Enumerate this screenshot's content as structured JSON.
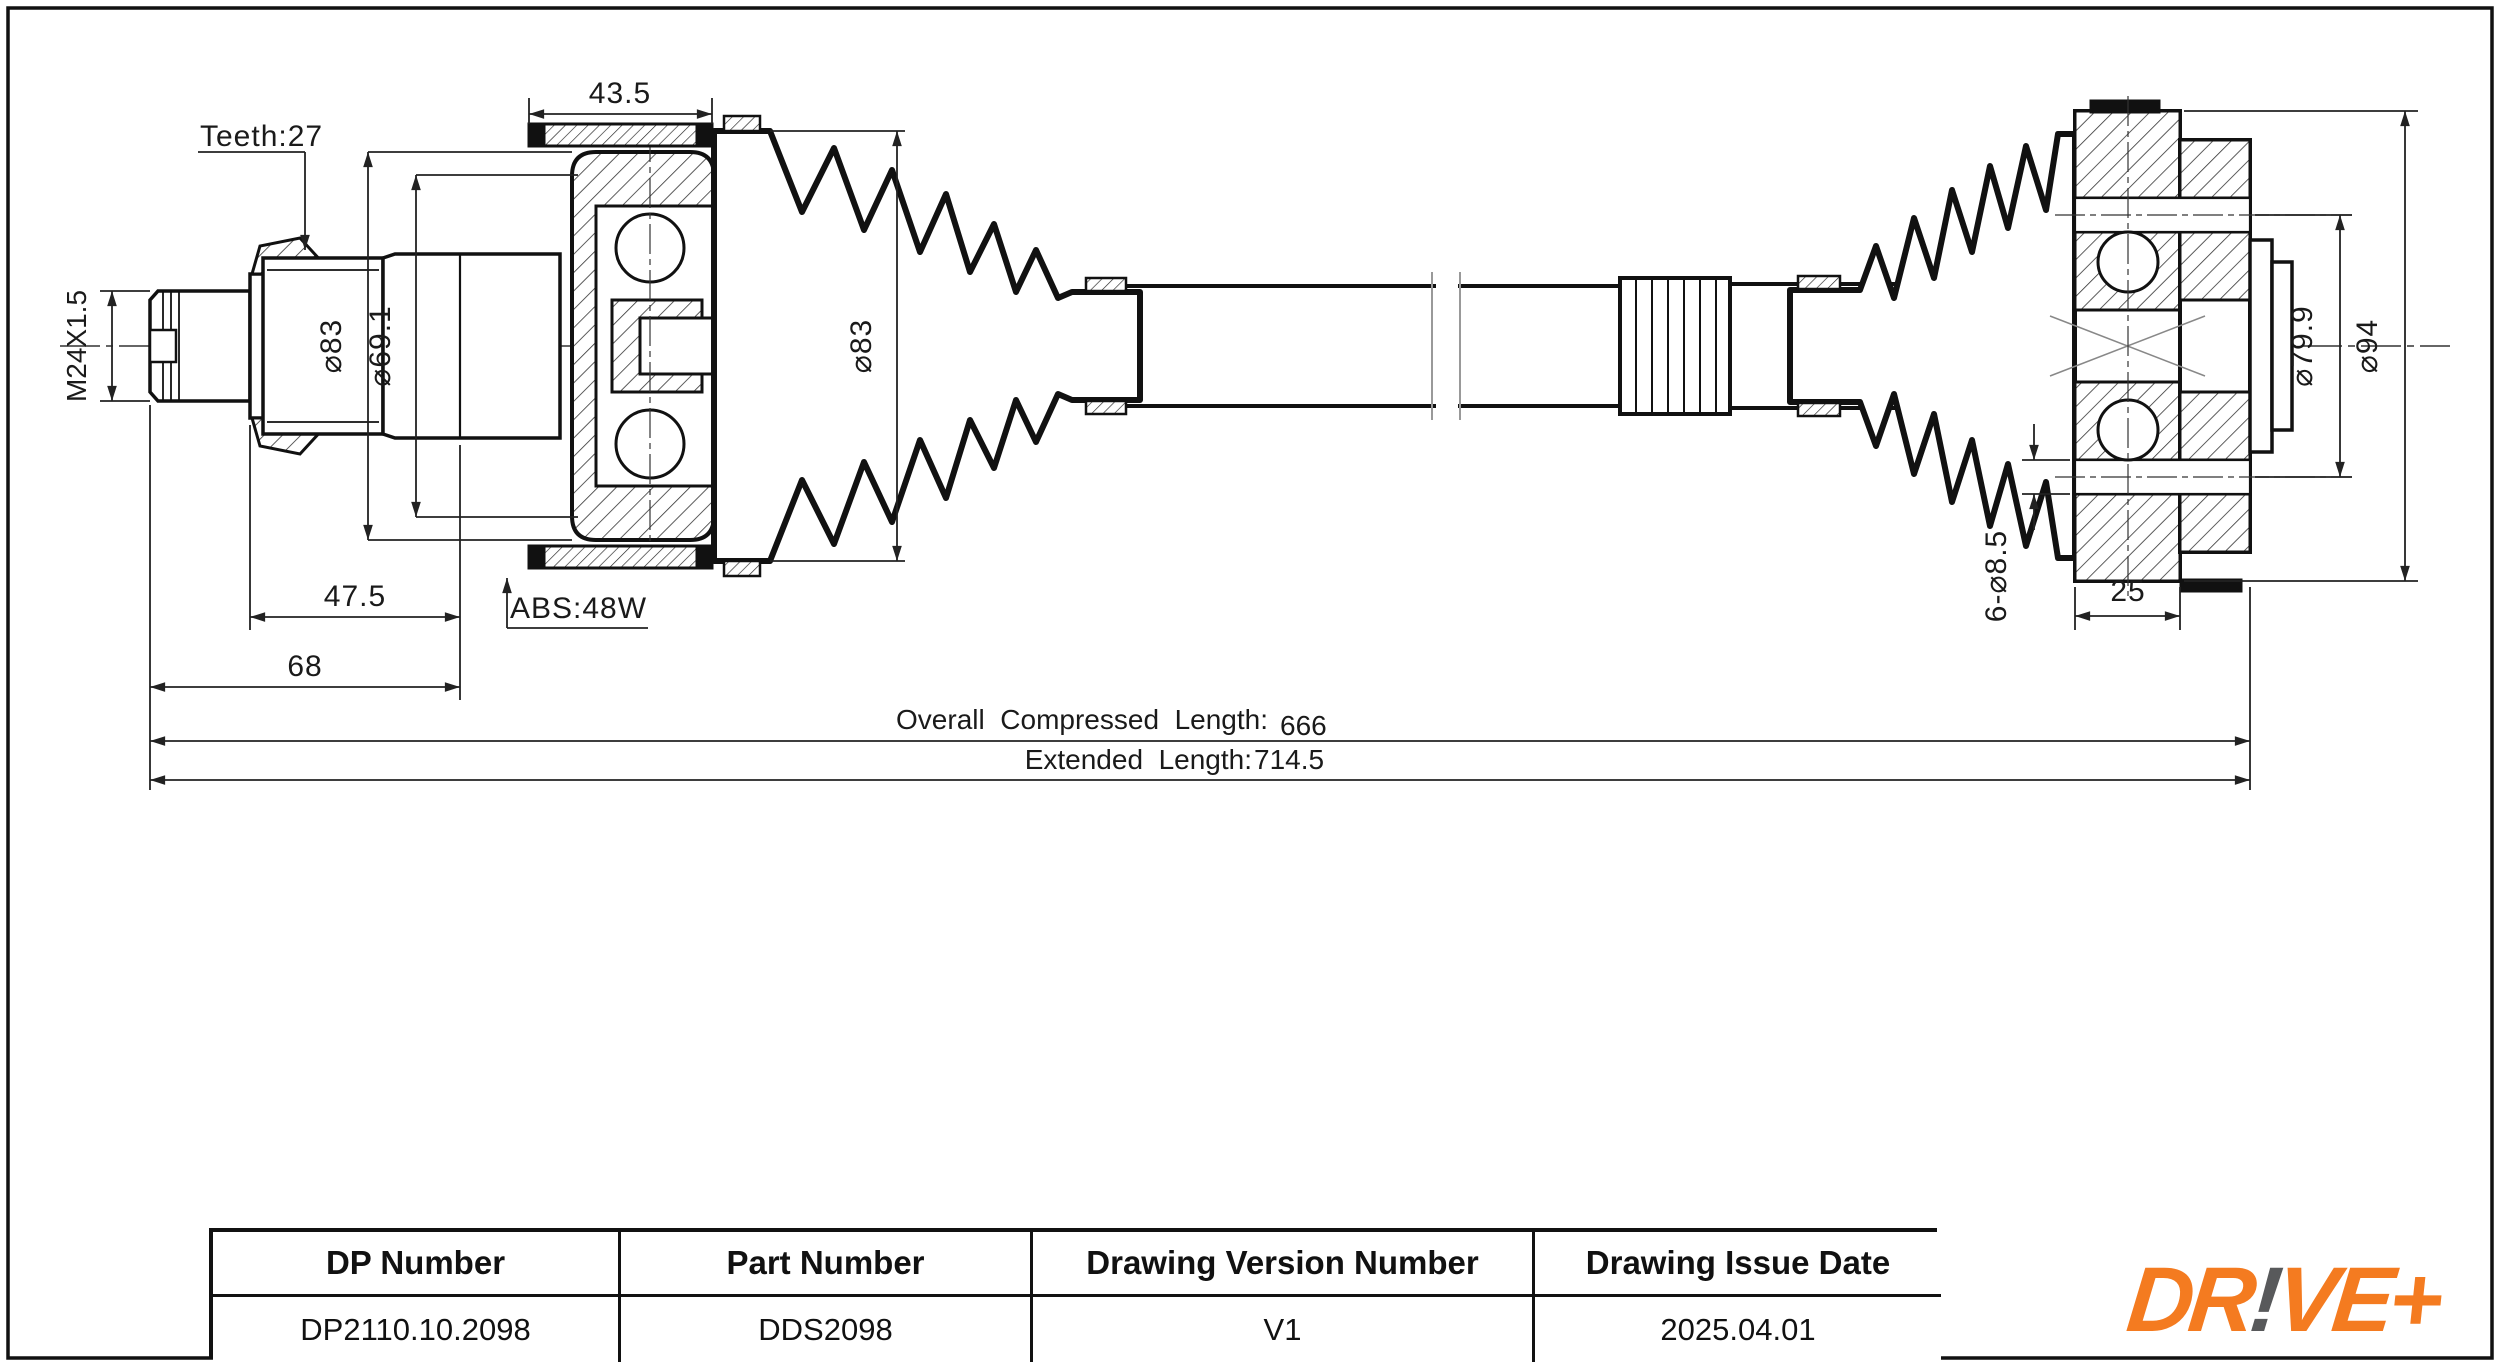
{
  "annotations": {
    "teeth_label": "Teeth:27",
    "abs_label": "ABS:48W"
  },
  "dimensions": {
    "abs_ring_width": "43.5",
    "thread_spec": "M24X1.5",
    "joint_outer_diameter": "⌀83",
    "joint_inner_diameter": "⌀69.1",
    "boot_diameter": "⌀83",
    "spline_length": "47.5",
    "stub_length": "68",
    "bolt_circle_diameter": "⌀79.9",
    "flange_diameter": "⌀94",
    "bolt_holes": "6-⌀8.5",
    "hub_width": "25",
    "compressed_label": "Overall  Compressed  Length:",
    "compressed_value": "666",
    "extended_label": "Extended  Length:",
    "extended_value": "714.5"
  },
  "title_block": {
    "headers": [
      "DP Number",
      "Part Number",
      "Drawing Version Number",
      "Drawing Issue Date"
    ],
    "values": [
      "DP2110.10.2098",
      "DDS2098",
      "V1",
      "2025.04.01"
    ]
  },
  "logo": {
    "dr": "DR",
    "bang": "!",
    "veplus": "VE+"
  },
  "colors": {
    "logo_orange": "#F47B20",
    "logo_gray": "#58595B",
    "line": "#1a1a1a"
  }
}
